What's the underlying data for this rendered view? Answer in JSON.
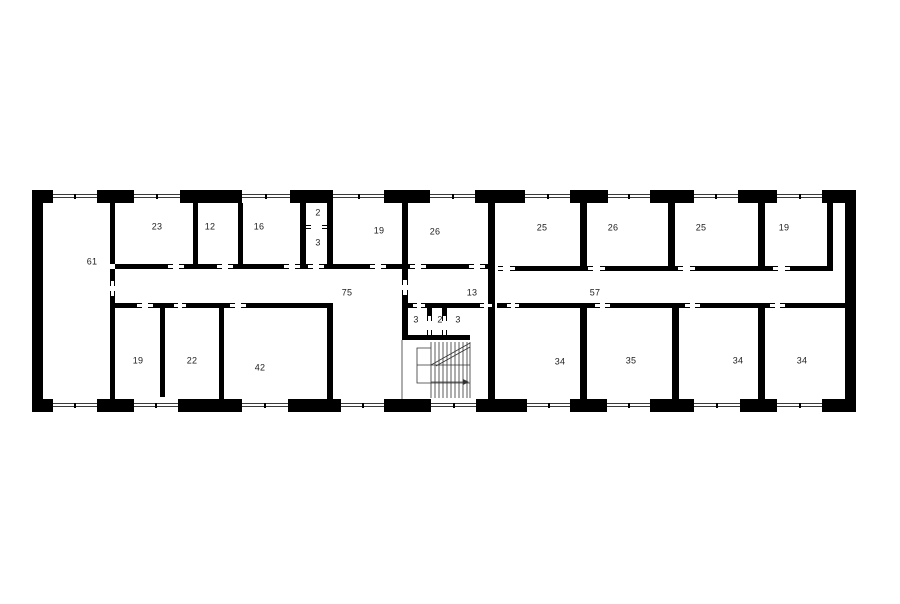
{
  "title": "Building storey floor plan",
  "colors": {
    "wall": "#000000",
    "thin_line": "#3a3a3a",
    "label": "#1d1d1d",
    "background": "#ffffff"
  },
  "plan": {
    "rooms": [
      {
        "label": "61",
        "x": 92,
        "y": 262
      },
      {
        "label": "23",
        "x": 157,
        "y": 227
      },
      {
        "label": "12",
        "x": 210,
        "y": 227
      },
      {
        "label": "16",
        "x": 259,
        "y": 227
      },
      {
        "label": "2",
        "x": 318,
        "y": 213
      },
      {
        "label": "3",
        "x": 318,
        "y": 243
      },
      {
        "label": "19",
        "x": 379,
        "y": 231
      },
      {
        "label": "26",
        "x": 435,
        "y": 232
      },
      {
        "label": "25",
        "x": 542,
        "y": 228
      },
      {
        "label": "26",
        "x": 613,
        "y": 228
      },
      {
        "label": "25",
        "x": 701,
        "y": 228
      },
      {
        "label": "19",
        "x": 784,
        "y": 228
      },
      {
        "label": "75",
        "x": 347,
        "y": 293
      },
      {
        "label": "13",
        "x": 472,
        "y": 293
      },
      {
        "label": "57",
        "x": 595,
        "y": 293
      },
      {
        "label": "3",
        "x": 416,
        "y": 320
      },
      {
        "label": "2",
        "x": 440,
        "y": 320
      },
      {
        "label": "3",
        "x": 458,
        "y": 320
      },
      {
        "label": "19",
        "x": 138,
        "y": 361
      },
      {
        "label": "22",
        "x": 192,
        "y": 361
      },
      {
        "label": "42",
        "x": 260,
        "y": 368
      },
      {
        "label": "34",
        "x": 560,
        "y": 362
      },
      {
        "label": "35",
        "x": 631,
        "y": 361
      },
      {
        "label": "34",
        "x": 738,
        "y": 361
      },
      {
        "label": "34",
        "x": 802,
        "y": 361
      }
    ],
    "walls": [
      [
        32,
        190,
        11,
        222
      ],
      [
        845,
        190,
        11,
        222
      ],
      [
        32,
        190,
        21,
        13
      ],
      [
        97,
        190,
        37,
        13
      ],
      [
        180,
        190,
        62,
        13
      ],
      [
        290,
        190,
        43,
        13
      ],
      [
        384,
        190,
        46,
        13
      ],
      [
        475,
        190,
        50,
        13
      ],
      [
        570,
        190,
        38,
        13
      ],
      [
        650,
        190,
        44,
        13
      ],
      [
        738,
        190,
        39,
        13
      ],
      [
        822,
        190,
        34,
        13
      ],
      [
        32,
        399,
        21,
        13
      ],
      [
        97,
        399,
        37,
        13
      ],
      [
        178,
        399,
        64,
        13
      ],
      [
        288,
        399,
        53,
        13
      ],
      [
        384,
        399,
        47,
        13
      ],
      [
        476,
        399,
        51,
        13
      ],
      [
        570,
        399,
        37,
        13
      ],
      [
        650,
        399,
        44,
        13
      ],
      [
        740,
        399,
        37,
        13
      ],
      [
        822,
        399,
        34,
        13
      ],
      [
        110,
        203,
        5,
        61
      ],
      [
        110,
        269,
        5,
        12
      ],
      [
        110,
        296,
        5,
        103
      ],
      [
        193,
        203,
        5,
        61
      ],
      [
        238,
        203,
        5,
        61
      ],
      [
        300,
        203,
        6,
        61
      ],
      [
        327,
        203,
        6,
        61
      ],
      [
        402,
        203,
        6,
        61
      ],
      [
        402,
        269,
        6,
        11
      ],
      [
        402,
        295,
        6,
        45
      ],
      [
        488,
        203,
        7,
        196
      ],
      [
        580,
        203,
        7,
        63
      ],
      [
        668,
        203,
        7,
        63
      ],
      [
        758,
        203,
        7,
        63
      ],
      [
        827,
        203,
        6,
        68
      ],
      [
        160,
        308,
        5,
        89
      ],
      [
        219,
        308,
        5,
        91
      ],
      [
        327,
        308,
        6,
        91
      ],
      [
        580,
        308,
        7,
        91
      ],
      [
        672,
        308,
        7,
        91
      ],
      [
        758,
        308,
        7,
        91
      ],
      [
        427,
        308,
        5,
        8
      ],
      [
        442,
        308,
        5,
        8
      ],
      [
        115,
        264,
        53,
        5
      ],
      [
        184,
        264,
        33,
        5
      ],
      [
        233,
        264,
        51,
        5
      ],
      [
        300,
        264,
        8,
        5
      ],
      [
        324,
        264,
        46,
        5
      ],
      [
        386,
        264,
        24,
        5
      ],
      [
        426,
        264,
        43,
        5
      ],
      [
        485,
        264,
        10,
        5
      ],
      [
        515,
        266,
        73,
        5
      ],
      [
        605,
        266,
        73,
        5
      ],
      [
        695,
        266,
        78,
        5
      ],
      [
        790,
        266,
        43,
        5
      ],
      [
        115,
        303,
        22,
        5
      ],
      [
        153,
        303,
        21,
        5
      ],
      [
        186,
        303,
        44,
        5
      ],
      [
        246,
        303,
        87,
        5
      ],
      [
        403,
        303,
        10,
        5
      ],
      [
        425,
        303,
        55,
        5
      ],
      [
        497,
        303,
        10,
        5
      ],
      [
        519,
        303,
        76,
        5
      ],
      [
        610,
        303,
        75,
        5
      ],
      [
        700,
        303,
        70,
        5
      ],
      [
        785,
        303,
        71,
        5
      ],
      [
        402,
        335,
        68,
        5
      ]
    ],
    "windows": [
      [
        53,
        194,
        44
      ],
      [
        134,
        194,
        46
      ],
      [
        242,
        194,
        48
      ],
      [
        333,
        194,
        51
      ],
      [
        430,
        194,
        45
      ],
      [
        525,
        194,
        45
      ],
      [
        608,
        194,
        42
      ],
      [
        694,
        194,
        44
      ],
      [
        777,
        194,
        45
      ],
      [
        53,
        403,
        44
      ],
      [
        134,
        403,
        44
      ],
      [
        242,
        403,
        46
      ],
      [
        341,
        403,
        43
      ],
      [
        431,
        403,
        45
      ],
      [
        527,
        403,
        43
      ],
      [
        607,
        403,
        43
      ],
      [
        694,
        403,
        46
      ],
      [
        777,
        403,
        45
      ]
    ],
    "doors": [
      {
        "x": 168,
        "y": 264,
        "len": 16,
        "t": 5,
        "o": "h"
      },
      {
        "x": 217,
        "y": 264,
        "len": 16,
        "t": 5,
        "o": "h"
      },
      {
        "x": 284,
        "y": 264,
        "len": 16,
        "t": 5,
        "o": "h"
      },
      {
        "x": 308,
        "y": 264,
        "len": 16,
        "t": 5,
        "o": "h"
      },
      {
        "x": 370,
        "y": 264,
        "len": 16,
        "t": 5,
        "o": "h"
      },
      {
        "x": 410,
        "y": 264,
        "len": 16,
        "t": 5,
        "o": "h"
      },
      {
        "x": 469,
        "y": 264,
        "len": 16,
        "t": 5,
        "o": "h"
      },
      {
        "x": 306,
        "y": 225,
        "len": 21,
        "t": 4,
        "o": "h"
      },
      {
        "x": 498,
        "y": 266,
        "len": 17,
        "t": 5,
        "o": "h"
      },
      {
        "x": 588,
        "y": 266,
        "len": 17,
        "t": 5,
        "o": "h"
      },
      {
        "x": 678,
        "y": 266,
        "len": 17,
        "t": 5,
        "o": "h"
      },
      {
        "x": 773,
        "y": 266,
        "len": 17,
        "t": 5,
        "o": "h"
      },
      {
        "x": 137,
        "y": 303,
        "len": 16,
        "t": 5,
        "o": "h"
      },
      {
        "x": 174,
        "y": 303,
        "len": 12,
        "t": 5,
        "o": "h"
      },
      {
        "x": 230,
        "y": 303,
        "len": 16,
        "t": 5,
        "o": "h"
      },
      {
        "x": 413,
        "y": 303,
        "len": 12,
        "t": 5,
        "o": "h"
      },
      {
        "x": 480,
        "y": 303,
        "len": 12,
        "t": 5,
        "o": "h"
      },
      {
        "x": 507,
        "y": 303,
        "len": 12,
        "t": 5,
        "o": "h"
      },
      {
        "x": 595,
        "y": 303,
        "len": 15,
        "t": 5,
        "o": "h"
      },
      {
        "x": 685,
        "y": 303,
        "len": 15,
        "t": 5,
        "o": "h"
      },
      {
        "x": 770,
        "y": 303,
        "len": 15,
        "t": 5,
        "o": "h"
      },
      {
        "x": 110,
        "y": 281,
        "len": 15,
        "t": 5,
        "o": "v"
      },
      {
        "x": 402,
        "y": 280,
        "len": 15,
        "t": 6,
        "o": "v"
      },
      {
        "x": 427,
        "y": 316,
        "len": 19,
        "t": 5,
        "o": "v"
      },
      {
        "x": 442,
        "y": 316,
        "len": 19,
        "t": 5,
        "o": "v"
      }
    ]
  }
}
